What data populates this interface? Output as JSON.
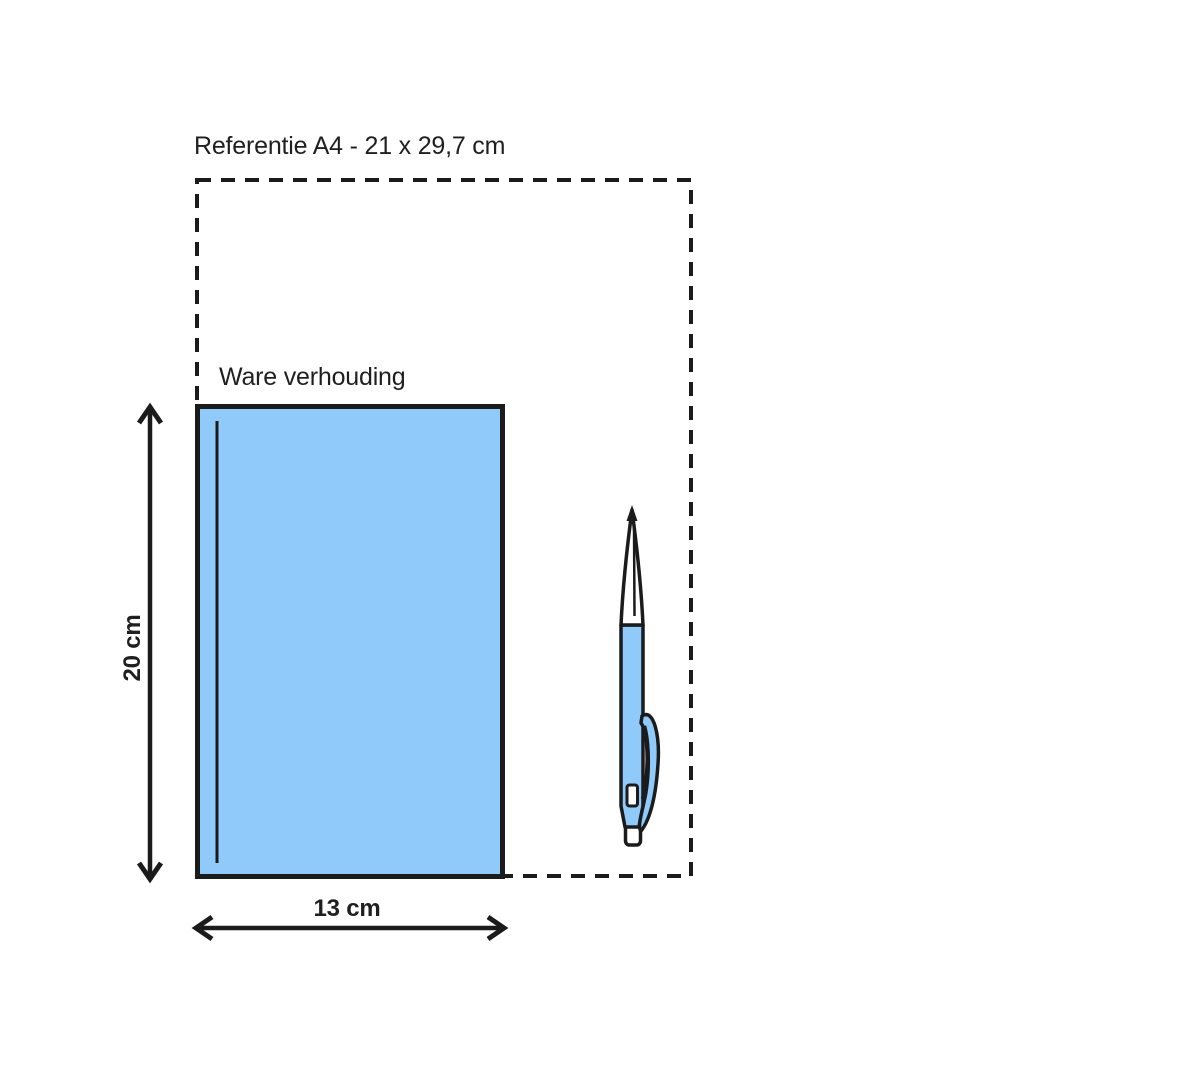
{
  "diagram": {
    "reference_label": "Referentie A4 - 21 x 29,7 cm",
    "scale_label": "Ware verhouding",
    "height_dimension": "20 cm",
    "width_dimension": "13 cm",
    "colors": {
      "background": "#ffffff",
      "outline": "#1b1b1b",
      "product_fill": "#8fcafb",
      "pen_fill": "#8fcafb",
      "pen_tip_fill": "#ffffff"
    }
  }
}
